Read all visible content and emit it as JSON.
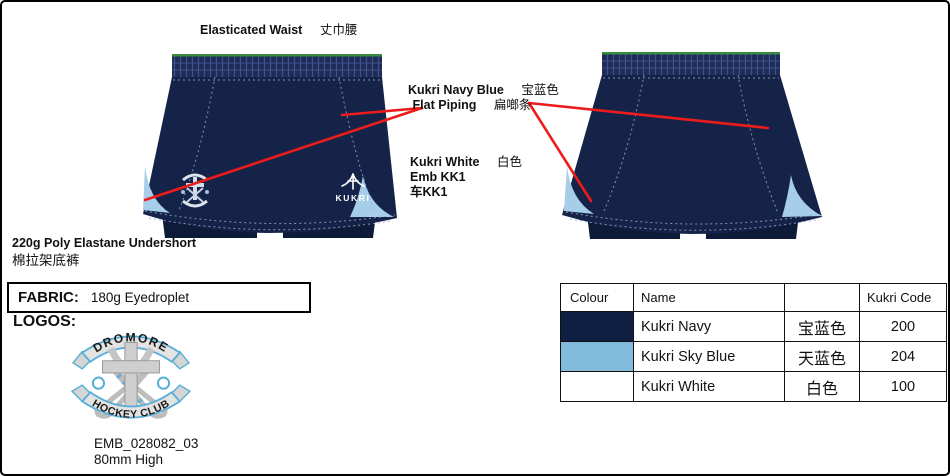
{
  "colors": {
    "navy": "#162349",
    "navy_deep": "#0d1a38",
    "waistband": "#1d2c58",
    "waist_grid": "#41528a",
    "stitch": "#93a7cc",
    "sky": "#a7cee8",
    "green": "#3c8a40",
    "red": "#ec1c1c",
    "crest_gray": "#cfcfcf",
    "crest_gray_dark": "#9a9a9a",
    "crest_blue": "#58aed6",
    "ribbon_fill": "#e3e3e3"
  },
  "annotations": {
    "waist": {
      "en": "Elasticated Waist",
      "zh": "丈巾腰"
    },
    "piping": {
      "en1": "Kukri Navy Blue",
      "zh1": "宝蓝色",
      "en2": "Flat Piping",
      "zh2": "扁啷条"
    },
    "emb": {
      "en1": "Kukri White",
      "zh1": "白色",
      "line2": "Emb KK1",
      "line3": "车KK1"
    },
    "undershort": {
      "en": "220g Poly Elastane Undershort",
      "zh": "棉拉架底裤"
    }
  },
  "garment": {
    "brand": "KUKRI"
  },
  "fabric": {
    "label": "FABRIC:",
    "value": "180g Eyedroplet"
  },
  "logos": {
    "label": "LOGOS:",
    "banner_top": "DROMORE",
    "banner_bottom": "HOCKEY CLUB",
    "emb_code": "EMB_028082_03",
    "emb_height": "80mm High"
  },
  "color_table": {
    "headers": {
      "colour": "Colour",
      "name": "Name",
      "cn": "",
      "code": "Kukri Code"
    },
    "rows": [
      {
        "swatch": "#0e1f41",
        "name": "Kukri Navy",
        "zh": "宝蓝色",
        "code": "200"
      },
      {
        "swatch": "#82badb",
        "name": "Kukri Sky Blue",
        "zh": "天蓝色",
        "code": "204"
      },
      {
        "swatch": "#ffffff",
        "name": "Kukri White",
        "zh": "白色",
        "code": "100"
      }
    ]
  }
}
